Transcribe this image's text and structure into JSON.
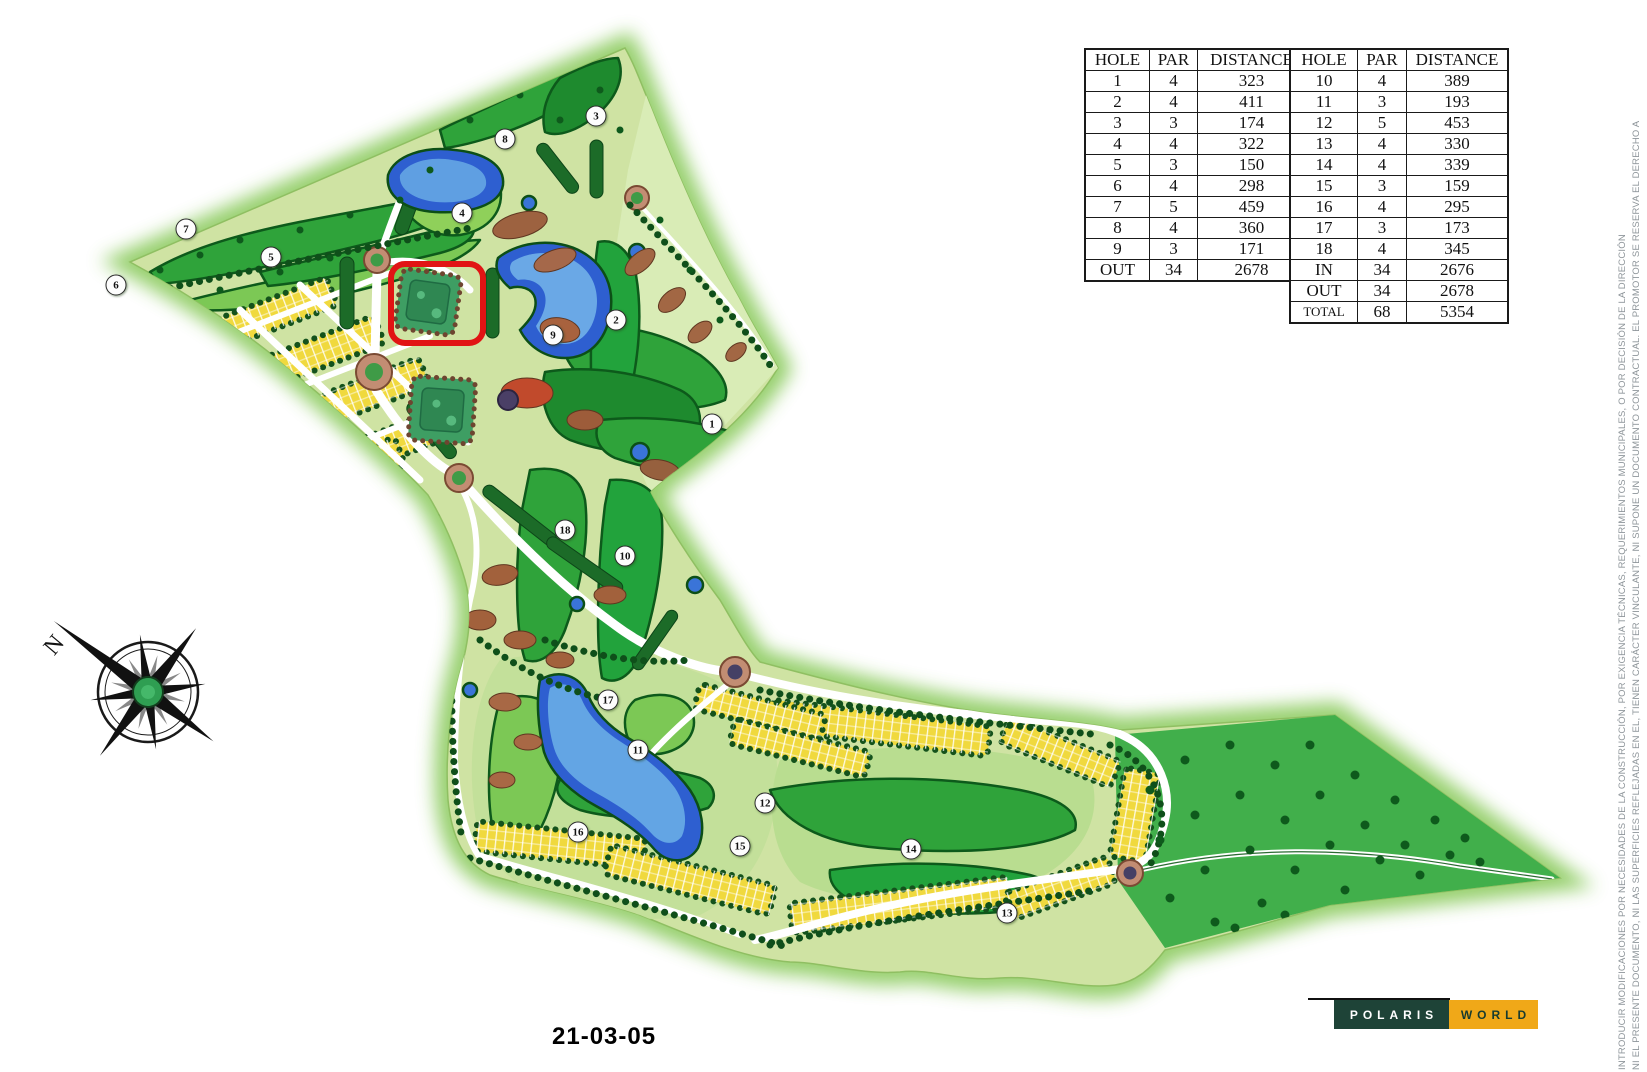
{
  "scorecard": {
    "headers": [
      "HOLE",
      "PAR",
      "DISTANCE"
    ],
    "front_nine": [
      [
        "1",
        "4",
        "323"
      ],
      [
        "2",
        "4",
        "411"
      ],
      [
        "3",
        "3",
        "174"
      ],
      [
        "4",
        "4",
        "322"
      ],
      [
        "5",
        "3",
        "150"
      ],
      [
        "6",
        "4",
        "298"
      ],
      [
        "7",
        "5",
        "459"
      ],
      [
        "8",
        "4",
        "360"
      ],
      [
        "9",
        "3",
        "171"
      ],
      [
        "OUT",
        "34",
        "2678"
      ]
    ],
    "back_nine": [
      [
        "10",
        "4",
        "389"
      ],
      [
        "11",
        "3",
        "193"
      ],
      [
        "12",
        "5",
        "453"
      ],
      [
        "13",
        "4",
        "330"
      ],
      [
        "14",
        "4",
        "339"
      ],
      [
        "15",
        "3",
        "159"
      ],
      [
        "16",
        "4",
        "295"
      ],
      [
        "17",
        "3",
        "173"
      ],
      [
        "18",
        "4",
        "345"
      ],
      [
        "IN",
        "34",
        "2676"
      ],
      [
        "OUT",
        "34",
        "2678"
      ],
      [
        "TOTAL",
        "68",
        "5354"
      ]
    ]
  },
  "map": {
    "hole_markers": [
      {
        "n": "1",
        "x": 712,
        "y": 424
      },
      {
        "n": "2",
        "x": 616,
        "y": 320
      },
      {
        "n": "3",
        "x": 596,
        "y": 116
      },
      {
        "n": "4",
        "x": 462,
        "y": 213
      },
      {
        "n": "5",
        "x": 271,
        "y": 257
      },
      {
        "n": "6",
        "x": 116,
        "y": 285
      },
      {
        "n": "7",
        "x": 186,
        "y": 229
      },
      {
        "n": "8",
        "x": 505,
        "y": 139
      },
      {
        "n": "9",
        "x": 553,
        "y": 335
      },
      {
        "n": "10",
        "x": 625,
        "y": 556
      },
      {
        "n": "11",
        "x": 638,
        "y": 750
      },
      {
        "n": "12",
        "x": 765,
        "y": 803
      },
      {
        "n": "13",
        "x": 1007,
        "y": 913
      },
      {
        "n": "14",
        "x": 911,
        "y": 849
      },
      {
        "n": "15",
        "x": 740,
        "y": 846
      },
      {
        "n": "16",
        "x": 578,
        "y": 832
      },
      {
        "n": "17",
        "x": 608,
        "y": 700
      },
      {
        "n": "18",
        "x": 565,
        "y": 530
      }
    ],
    "highlight": {
      "x": 388,
      "y": 261,
      "w": 98,
      "h": 85,
      "color": "#e11414"
    }
  },
  "compass": {
    "north_label": "N"
  },
  "footer": {
    "date": "21-03-05"
  },
  "logo": {
    "polaris": "POLARIS",
    "world": "WORLD",
    "green": "#1e4337",
    "orange": "#f0a818"
  },
  "disclaimer": {
    "line1": "NI EL PRESENTE DOCUMENTO, NI LAS SUPERFICIES REFLEJADAS EN EL, TIENEN CARÁCTER VINCULANTE, NI SUPONE UN DOCUMENTO CONTRACTUAL. EL PROMOTOR SE RESERVA EL DERECHO A",
    "line2": "INTRODUCIR MODIFICACIONES POR NECESIDADES DE LA CONSTRUCCIÓN, POR EXIGENCIA TÉCNICAS, REQUERIMIENTOS MUNICIPALES, O POR DECISIÓN DE LA DIRECCIÓN"
  }
}
